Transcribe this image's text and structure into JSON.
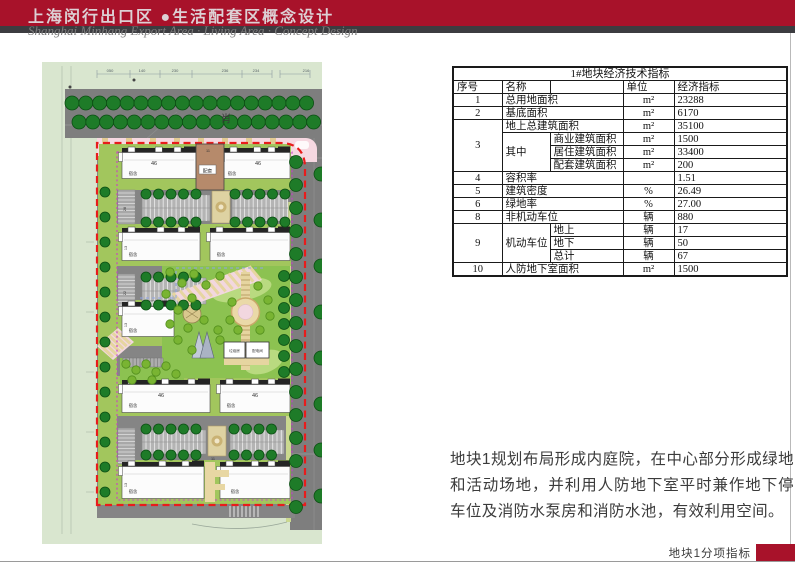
{
  "header": {
    "title_cn": "上海闵行出口区 ●生活配套区概念设计",
    "title_en": "Shanghai Minhang Export Area · Living Area · Concept Design"
  },
  "table": {
    "title": "1#地块经济技术指标",
    "headers": {
      "no": "序号",
      "name": "名称",
      "unit": "单位",
      "indicator": "经济指标"
    },
    "rows": {
      "r1": {
        "no": "1",
        "name": "总用地面积",
        "unit": "m²",
        "value": "23288"
      },
      "r2": {
        "no": "2",
        "name": "基底面积",
        "unit": "m²",
        "value": "6170"
      },
      "r3a": {
        "no": "3",
        "name": "地上总建筑面积",
        "unit": "m²",
        "value": "35100"
      },
      "r3b": {
        "name": "其中",
        "sub": "商业建筑面积",
        "unit": "m²",
        "value": "1500"
      },
      "r3c": {
        "sub": "居住建筑面积",
        "unit": "m²",
        "value": "33400"
      },
      "r3d": {
        "sub": "配套建筑面积",
        "unit": "m²",
        "value": "200"
      },
      "r4": {
        "no": "4",
        "name": "容积率",
        "unit": "",
        "value": "1.51"
      },
      "r5": {
        "no": "5",
        "name": "建筑密度",
        "unit": "%",
        "value": "26.49"
      },
      "r6": {
        "no": "6",
        "name": "绿地率",
        "unit": "%",
        "value": "27.00"
      },
      "r8": {
        "no": "8",
        "name": "非机动车位",
        "unit": "辆",
        "value": "880"
      },
      "r9a": {
        "no": "9",
        "name": "机动车位",
        "sub": "地上",
        "unit": "辆",
        "value": "17"
      },
      "r9b": {
        "sub": "地下",
        "unit": "辆",
        "value": "50"
      },
      "r9c": {
        "sub": "总计",
        "unit": "辆",
        "value": "67"
      },
      "r10": {
        "no": "10",
        "name": "人防地下室面积",
        "unit": "m²",
        "value": "1500"
      }
    }
  },
  "description": {
    "text": "地块1规划布局形成内庭院，在中心部分形成绿地和活动场地，并利用人防地下室平时兼作地下停车位及消防水泵房和消防水池，有效利用空间。"
  },
  "footer": {
    "label": "地块1分项指标"
  },
  "colors": {
    "accent_red": "#a8122a",
    "boundary_red_dash": "#e81c1c",
    "boundary_magenta_dash": "#c93ec9",
    "road_gray": "#7e7e7e",
    "lawn_green": "#8cc251",
    "tree_dark_green": "#1e7b28",
    "tree_light_green": "#79b432",
    "sidewalk_pink": "#f6d8e1",
    "path_tan": "#e6d5a0",
    "support_brown": "#b68a6b",
    "bg_pale_green": "#d9e6cf"
  },
  "map": {
    "road_name": "肖",
    "labels": [
      {
        "t": "050",
        "x": 68,
        "y": 10,
        "s": 4,
        "c": "#556066"
      },
      {
        "t": "140",
        "x": 100,
        "y": 10,
        "s": 4,
        "c": "#556066"
      },
      {
        "t": "230",
        "x": 133,
        "y": 10,
        "s": 4,
        "c": "#556066"
      },
      {
        "t": "236",
        "x": 183,
        "y": 10,
        "s": 4,
        "c": "#556066"
      },
      {
        "t": "234",
        "x": 214,
        "y": 10,
        "s": 4,
        "c": "#556066"
      },
      {
        "t": "216",
        "x": 264,
        "y": 10,
        "s": 4,
        "c": "#556066"
      },
      {
        "t": "肖",
        "x": 184,
        "y": 60,
        "s": 10.5,
        "c": "#3a3a3a"
      },
      {
        "t": "46",
        "x": 112,
        "y": 103,
        "s": 5.5,
        "c": "#333"
      },
      {
        "t": "46",
        "x": 216,
        "y": 103,
        "s": 5.5,
        "c": "#333"
      },
      {
        "t": "11",
        "x": 166,
        "y": 90,
        "s": 3.8,
        "c": "#333"
      },
      {
        "t": "配套",
        "x": 165.5,
        "y": 110.5,
        "s": 4.8,
        "c": "#333"
      },
      {
        "t": "宿舍",
        "x": 91,
        "y": 113,
        "s": 4.3,
        "c": "#333"
      },
      {
        "t": "宿舍",
        "x": 190,
        "y": 113,
        "s": 4.3,
        "c": "#333"
      },
      {
        "t": "宿舍",
        "x": 91,
        "y": 194,
        "s": 4.3,
        "c": "#333"
      },
      {
        "t": "宿舍",
        "x": 179,
        "y": 194,
        "s": 4.3,
        "c": "#333"
      },
      {
        "t": "宿舍",
        "x": 91,
        "y": 270,
        "s": 4.3,
        "c": "#333"
      },
      {
        "t": "46",
        "x": 119,
        "y": 335,
        "s": 5.5,
        "c": "#333"
      },
      {
        "t": "46",
        "x": 213,
        "y": 335,
        "s": 5.5,
        "c": "#333"
      },
      {
        "t": "宿舍",
        "x": 91,
        "y": 345,
        "s": 4.3,
        "c": "#333"
      },
      {
        "t": "宿舍",
        "x": 189,
        "y": 345,
        "s": 4.3,
        "c": "#333"
      },
      {
        "t": "宿舍",
        "x": 91,
        "y": 431,
        "s": 4.3,
        "c": "#333"
      },
      {
        "t": "宿舍",
        "x": 193,
        "y": 431,
        "s": 4.3,
        "c": "#333"
      },
      {
        "t": "垃圾房",
        "x": 192.5,
        "y": 290,
        "s": 3.6,
        "c": "#333"
      },
      {
        "t": "配电间",
        "x": 215.5,
        "y": 290,
        "s": 3.6,
        "c": "#333"
      },
      {
        "t": "13",
        "x": 85,
        "y": 186,
        "s": 3.8,
        "c": "#333",
        "rot": -90
      },
      {
        "t": "13",
        "x": 85,
        "y": 263,
        "s": 3.8,
        "c": "#333",
        "rot": -90
      },
      {
        "t": "13",
        "x": 85,
        "y": 423,
        "s": 3.8,
        "c": "#333",
        "rot": -90
      },
      {
        "t": "28",
        "x": 84,
        "y": 147,
        "s": 3.8,
        "c": "#333",
        "rot": -90
      },
      {
        "t": "22",
        "x": 84,
        "y": 231,
        "s": 3.8,
        "c": "#333",
        "rot": -90
      },
      {
        "t": "11",
        "x": 171,
        "y": 398,
        "s": 3.8,
        "c": "#333"
      }
    ]
  }
}
